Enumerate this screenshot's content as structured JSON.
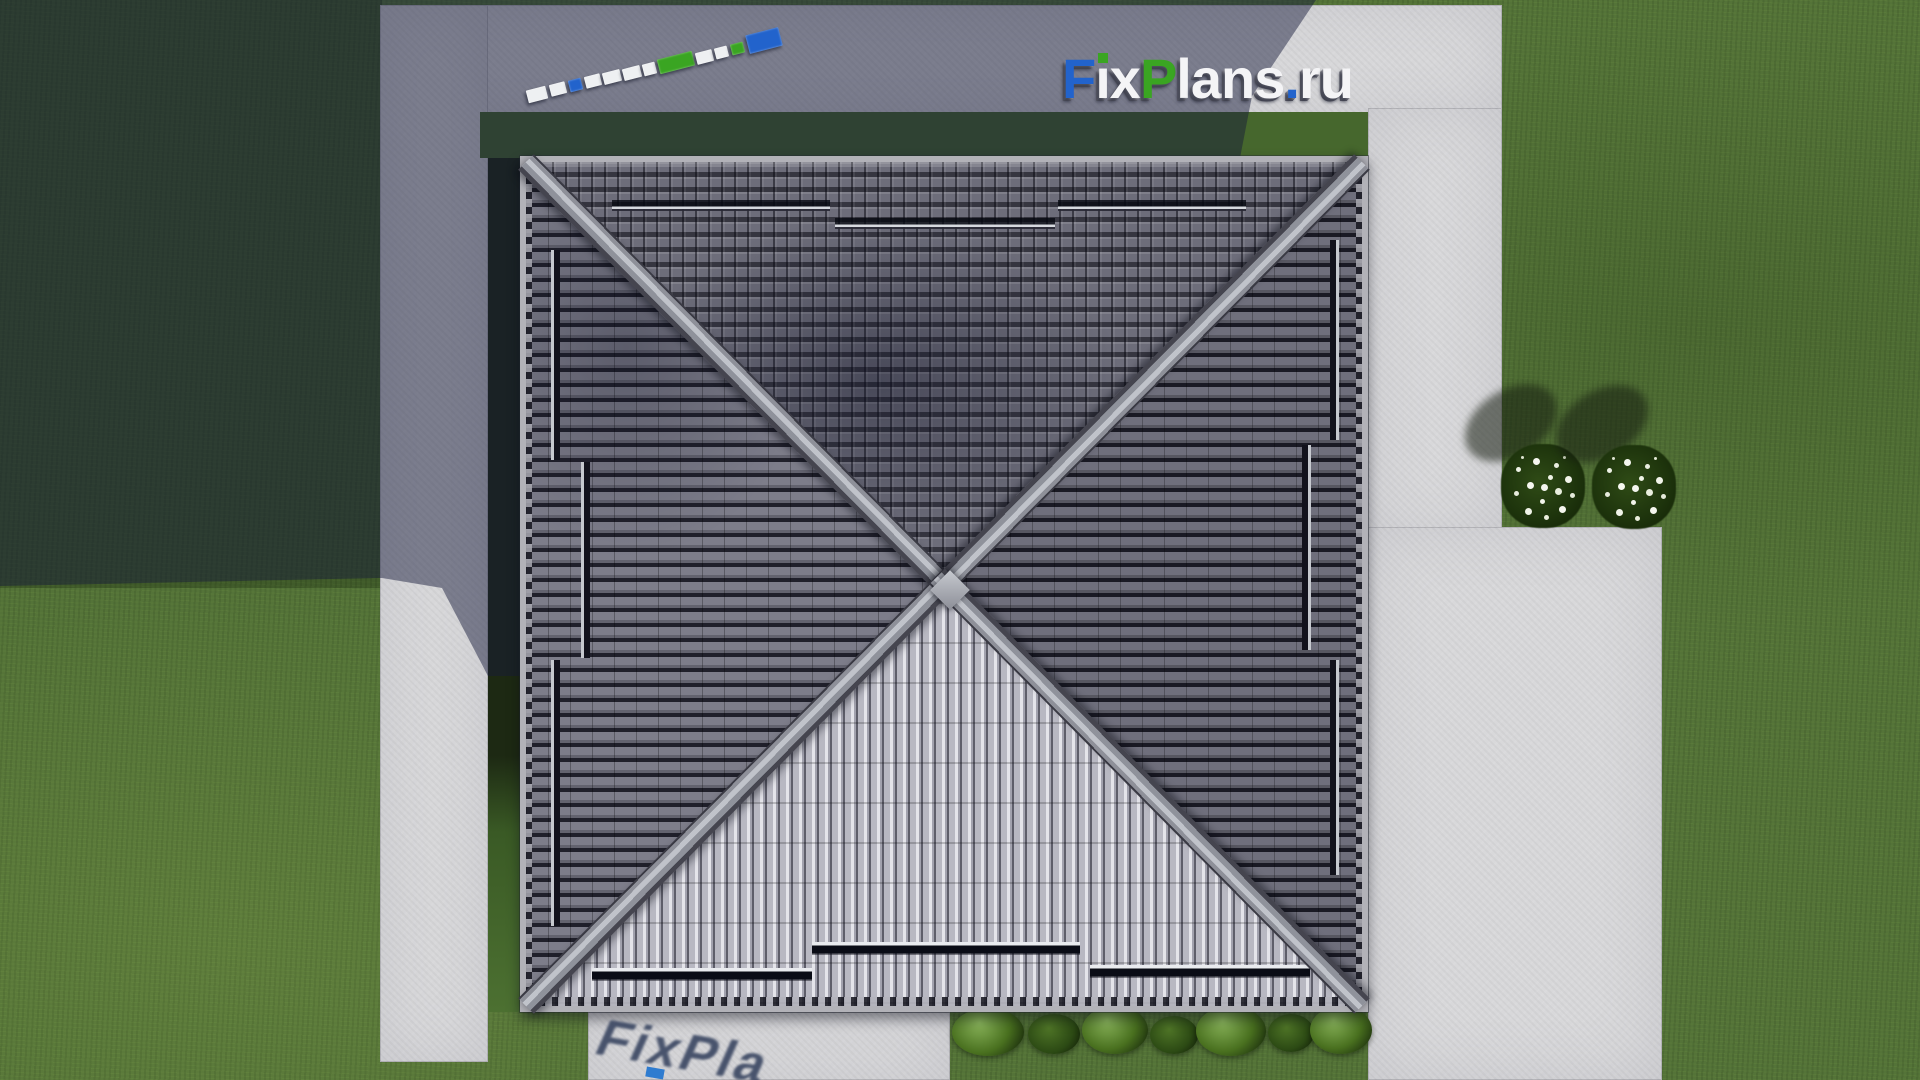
{
  "watermark": {
    "text": "FixPlans.ru",
    "letters": [
      {
        "ch": "F",
        "color": "#2263cc"
      },
      {
        "ch": "i",
        "color": "#f4f4f6",
        "tittle": "#3aa522"
      },
      {
        "ch": "x",
        "color": "#f4f4f6"
      },
      {
        "ch": "P",
        "color": "#3aa522"
      },
      {
        "ch": "l",
        "color": "#f4f4f6"
      },
      {
        "ch": "a",
        "color": "#f4f4f6"
      },
      {
        "ch": "n",
        "color": "#f4f4f6"
      },
      {
        "ch": "s",
        "color": "#f4f4f6"
      },
      {
        "ch": ".",
        "color": "#2263cc"
      },
      {
        "ch": "r",
        "color": "#f4f4f6"
      },
      {
        "ch": "u",
        "color": "#f4f4f6"
      }
    ],
    "shadow_text": "FixPla",
    "brand_colors": {
      "blue": "#2263cc",
      "green": "#3aa522",
      "white": "#f4f4f6"
    }
  },
  "scene": {
    "view": "top-down roof plan render",
    "ground": {
      "grass": "#547338",
      "grass_shadow": "#222d16",
      "concrete": "#d8d8da",
      "concrete_shadow": "#7b7e90",
      "cast_shadow": "rgba(24,28,58,0.48)"
    },
    "roof": {
      "type": "hip roof, square, X ridges",
      "fascia": "#b2b2b8",
      "ridge": "#c0c3ca",
      "face_north": "#6d6d7a",
      "face_west": "#70707d",
      "face_east": "#62626e",
      "face_south": "#b8b8c2"
    },
    "logo3d": {
      "angle": -14.5,
      "blocks": [
        {
          "x": 527,
          "y": 88,
          "w": 20,
          "h": 13,
          "color": "#eef0f2"
        },
        {
          "x": 550,
          "y": 83,
          "w": 16,
          "h": 12,
          "color": "#eef0f2"
        },
        {
          "x": 569,
          "y": 79,
          "w": 13,
          "h": 12,
          "color": "#2263cc"
        },
        {
          "x": 585,
          "y": 75,
          "w": 16,
          "h": 12,
          "color": "#eef0f2"
        },
        {
          "x": 603,
          "y": 71,
          "w": 18,
          "h": 12,
          "color": "#eef0f2"
        },
        {
          "x": 623,
          "y": 67,
          "w": 18,
          "h": 12,
          "color": "#eef0f2"
        },
        {
          "x": 643,
          "y": 63,
          "w": 13,
          "h": 12,
          "color": "#eef0f2"
        },
        {
          "x": 658,
          "y": 55,
          "w": 36,
          "h": 15,
          "color": "#3aa522"
        },
        {
          "x": 696,
          "y": 51,
          "w": 17,
          "h": 12,
          "color": "#eef0f2"
        },
        {
          "x": 715,
          "y": 47,
          "w": 13,
          "h": 11,
          "color": "#eef0f2"
        },
        {
          "x": 731,
          "y": 43,
          "w": 13,
          "h": 11,
          "color": "#3aa522"
        },
        {
          "x": 747,
          "y": 31,
          "w": 34,
          "h": 19,
          "color": "#2263cc"
        }
      ]
    },
    "hedge": {
      "bushes": [
        {
          "x": 952,
          "y": 1008,
          "w": 72,
          "h": 48,
          "dark": false
        },
        {
          "x": 1028,
          "y": 1014,
          "w": 52,
          "h": 40,
          "dark": true
        },
        {
          "x": 1082,
          "y": 1006,
          "w": 66,
          "h": 48,
          "dark": false
        },
        {
          "x": 1150,
          "y": 1016,
          "w": 48,
          "h": 38,
          "dark": true
        },
        {
          "x": 1196,
          "y": 1006,
          "w": 70,
          "h": 50,
          "dark": false
        },
        {
          "x": 1268,
          "y": 1014,
          "w": 46,
          "h": 38,
          "dark": true
        },
        {
          "x": 1310,
          "y": 1006,
          "w": 62,
          "h": 48,
          "dark": false
        }
      ]
    },
    "flowers": {
      "petal": "#f3f5ee",
      "foliage": "#1d330c",
      "bushes": [
        {
          "cx": 1543,
          "cy": 486
        },
        {
          "cx": 1634,
          "cy": 487
        }
      ]
    }
  }
}
